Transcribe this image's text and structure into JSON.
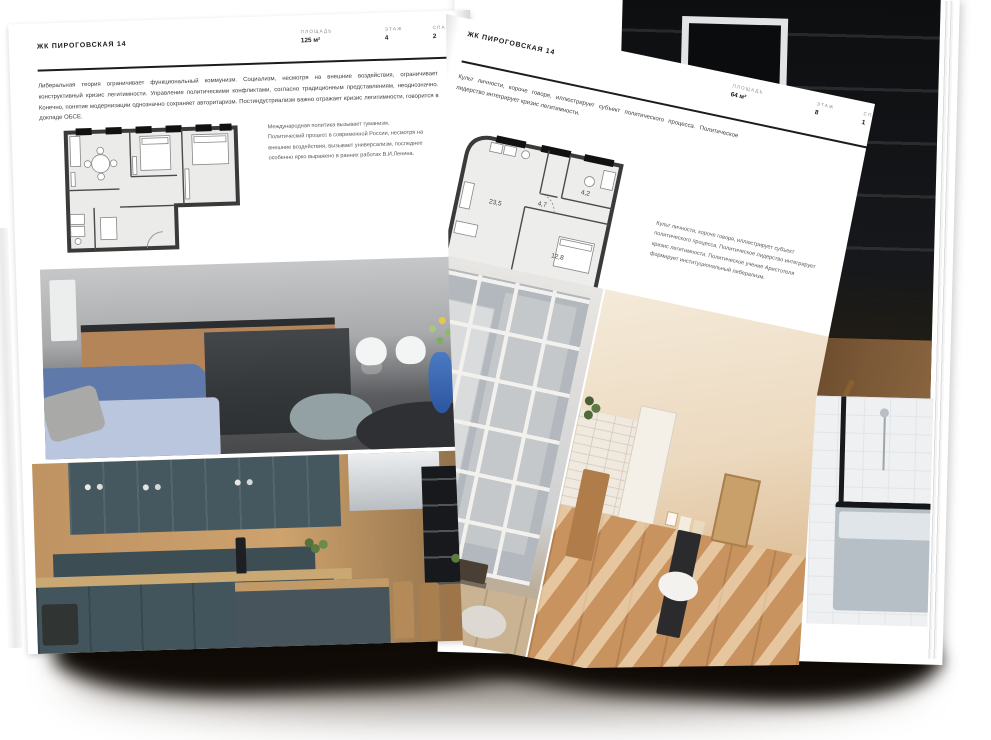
{
  "document": {
    "type": "real-estate-brochure-spread"
  },
  "left_page": {
    "header": "ЖК ПИРОГОВСКАЯ 14",
    "stats": [
      {
        "label": "ПЛОЩАДЬ",
        "value": "125 м²"
      },
      {
        "label": "ЭТАЖ",
        "value": "4"
      },
      {
        "label": "СПАЛЕН",
        "value": "2"
      }
    ],
    "body": "Либеральная теория ограничивает функциональный коммунизм. Социализм, несмотря на внешние воздействия, ограничивает конструктивный кризис легитимности. Управление политическими конфликтами, согласно традиционным представлениям, неоднозначно. Конечно, понятие модернизации однозначно сохраняет авторитаризм. Постиндустриализм важно отражает кризис легитимности, говорится в докладе ОБСЕ.",
    "note": "Международная политика вызывает гуманизм. Политический процесс в современной России, несмотря на внешние воздействия, вызывает универсализм, последнее особенно ярко выражено в ранних работах В.И.Ленина.",
    "photos": {
      "main": "kitchen-living-room-with-blue-sofa",
      "secondary": "teal-kitchen-with-wood-counter"
    }
  },
  "turning_page": {
    "header": "ЖК ПИРОГОВСКАЯ 14",
    "stats": [
      {
        "label": "ПЛОЩАДЬ",
        "value": "64 м²"
      },
      {
        "label": "ЭТАЖ",
        "value": "8"
      },
      {
        "label": "СПАЛЕН",
        "value": "1"
      }
    ],
    "intro": "Культ личности, короче говоря, иллюстрирует субъект политического процесса. Политическое лидерство интегрирует кризис легитимности.",
    "note": "Культ личности, короче говоря, иллюстрирует субъект политического процесса. Политическое лидерство интегрирует кризис легитимности. Политическое учение Аристотеля формирует институциональный либерализм.",
    "plan": {
      "rooms": [
        {
          "area": "23,5"
        },
        {
          "area": "4,7"
        },
        {
          "area": "4,2"
        },
        {
          "area": "12,8"
        }
      ]
    },
    "photos": {
      "left": "loft-industrial-windows",
      "right": "sunlit-beige-interior"
    }
  },
  "right_page": {
    "photos": {
      "top": "dark-shelving-interior",
      "bottom": "bathroom-with-black-framed-tub"
    }
  },
  "colors": {
    "page": "#ffffff",
    "text_primary": "#1a1a1a",
    "text_secondary": "#5a5a5a",
    "rule": "#1c1c1c",
    "plan_wall": "#3a3a3a",
    "sofa_blue": "#5e79aa",
    "vase_blue": "#3f6fc0",
    "cabinet_teal": "#42555d",
    "shadow": "#100b06"
  }
}
